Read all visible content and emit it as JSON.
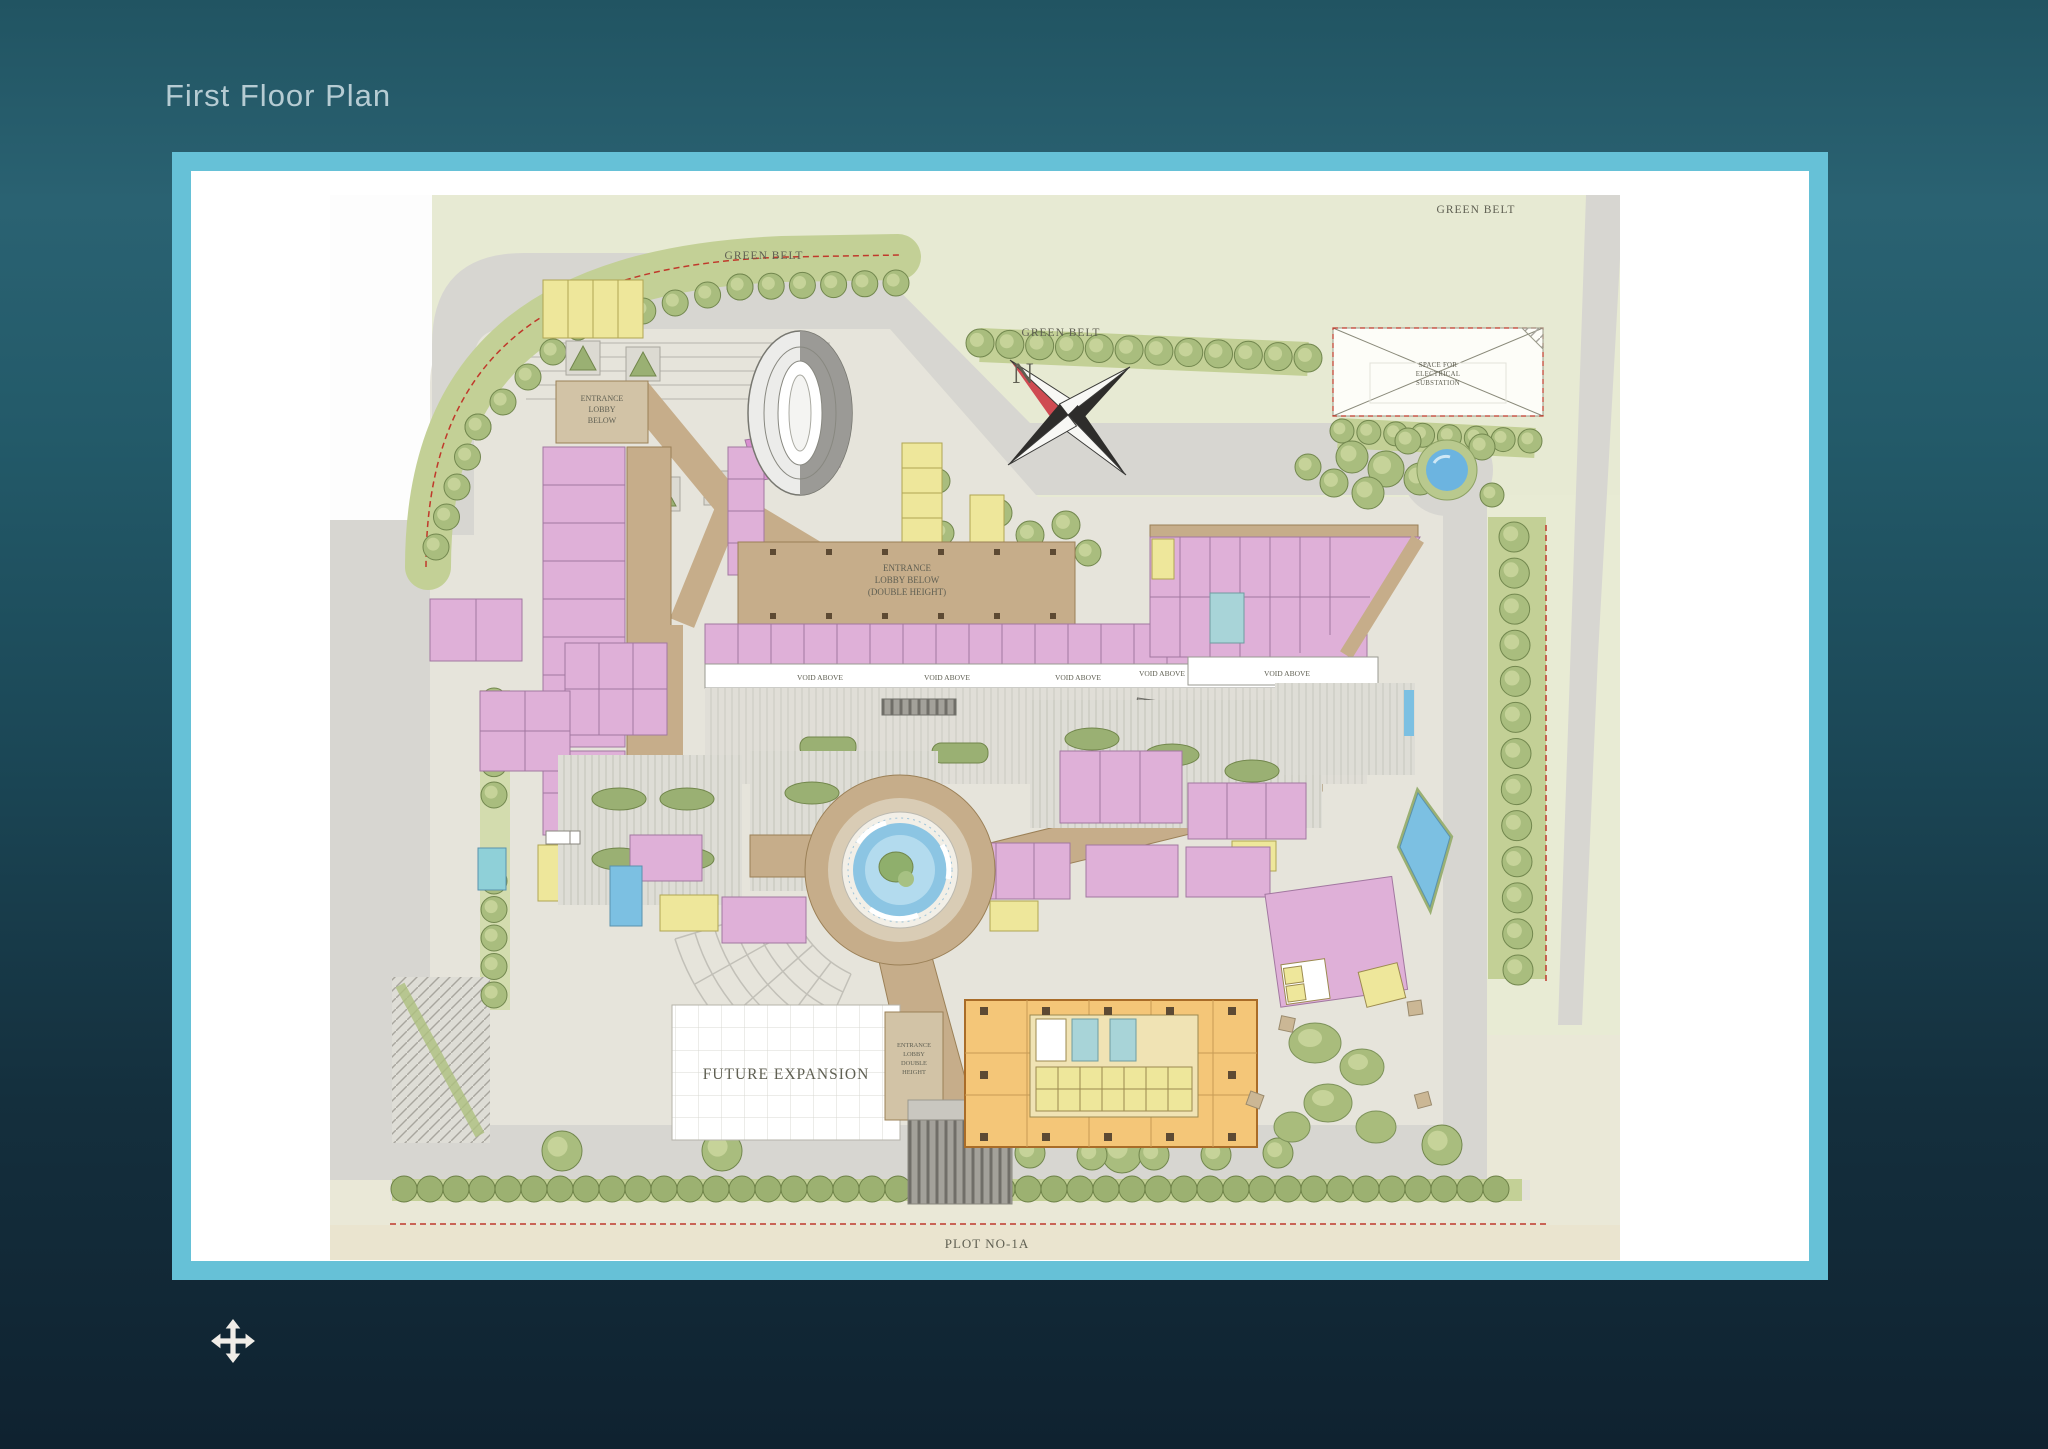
{
  "slide": {
    "title": "First Floor Plan"
  },
  "plan": {
    "labels": {
      "green_belt": "GREEN BELT",
      "north": "N",
      "substation_line1": "SPACE FOR",
      "substation_line2": "ELECTRICAL",
      "substation_line3": "SUBSTATION",
      "lobby_left_line1": "ENTRANCE",
      "lobby_left_line2": "LOBBY",
      "lobby_left_line3": "BELOW",
      "lobby_center_line1": "ENTRANCE",
      "lobby_center_line2": "LOBBY BELOW",
      "lobby_center_line3": "(DOUBLE HEIGHT)",
      "void_above": "VOID ABOVE",
      "future_expansion": "FUTURE EXPANSION",
      "lobby_tower_line1": "ENTRANCE",
      "lobby_tower_line2": "LOBBY",
      "lobby_tower_line3": "DOUBLE",
      "lobby_tower_line4": "HEIGHT",
      "plot_number": "PLOT NO-1A"
    },
    "colors": {
      "frame_border": "#66c1d7",
      "background_top": "#2a6272",
      "background_bottom": "#0f2230",
      "title_text": "#b6ccd3",
      "map_base": "#eae8d7",
      "road_gray": "#d7d6d1",
      "paving": "#e6e4db",
      "green_belt": "#c3d096",
      "tree_green": "#a9bd7e",
      "retail_pink": "#dfb0d8",
      "corridor_tan": "#c6ad8a",
      "core_yellow": "#eee79b",
      "tower_orange": "#f4c678",
      "water_blue": "#7cc0e2",
      "boundary_red": "#c0392b"
    },
    "icons": {
      "compass": "compass-rose",
      "pan": "pan-move-arrows"
    }
  }
}
